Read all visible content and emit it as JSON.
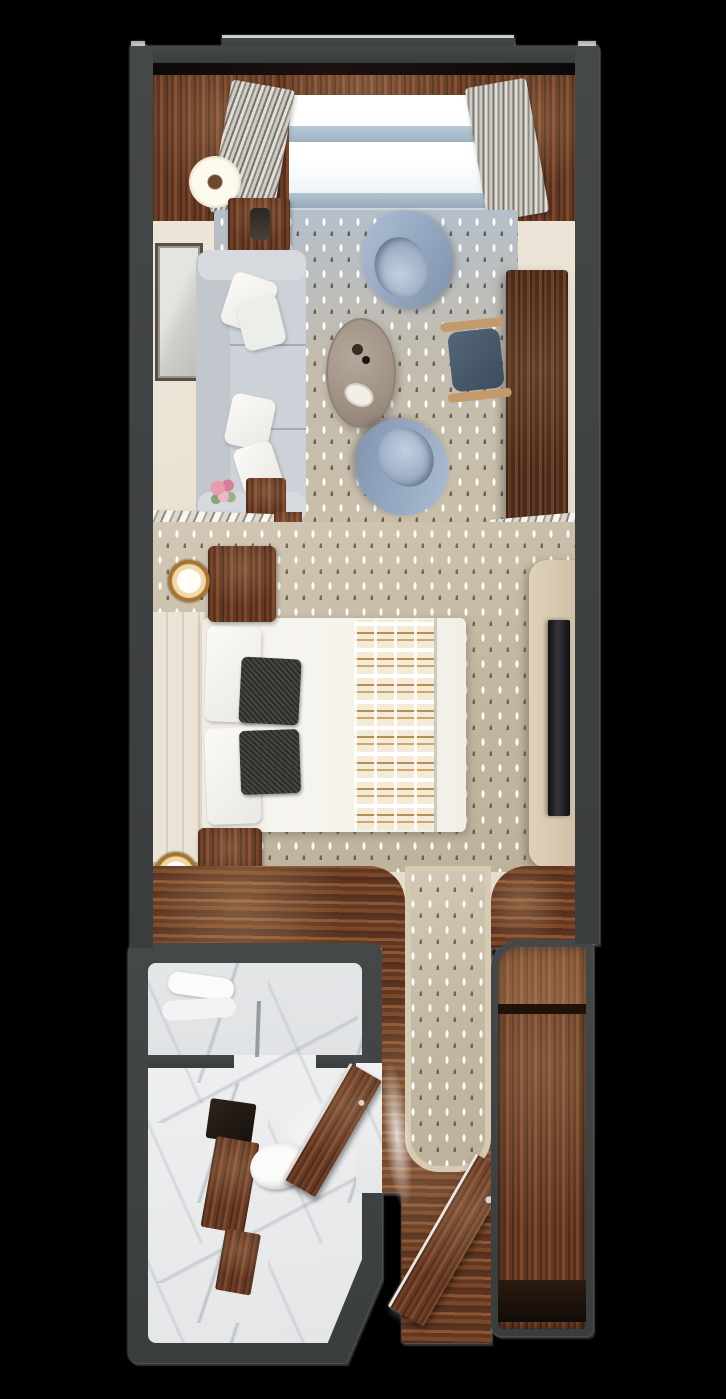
{
  "meta": {
    "title": "Stateroom suite floor plan — top-down 3D render",
    "view": "top-down architectural render",
    "visible_text": "none"
  },
  "palette": {
    "background": "#000000",
    "wall": "#3c4040",
    "wall_highlight": "#ffffff",
    "wood_mid": "#6e3f27",
    "wood_dark": "#4a2a18",
    "cream_floor": "#e9e2d4",
    "marble": "#eceeef",
    "rug_blue": "#b5bfca",
    "rug_beige": "#c9bea9",
    "carpet_beige": "#c2b7a1",
    "sofa_gray": "#cdd2d8",
    "armchair_blue": "#8ea3c0",
    "coffee_table_taupe": "#a89b8e",
    "desk_brown": "#5e3a26",
    "bed_white": "#f4f2ec",
    "accent_pillow_dark": "#2e2c29",
    "runner_tan": "#cda76b",
    "headboard_cream": "#ebe4d6",
    "tv_black": "#17171a",
    "console_beige": "#d7c8af",
    "window_glass": "#fdfdfd",
    "window_rail_blue": "#a9bac9",
    "glow_white": "#ffffff"
  },
  "zones": {
    "veranda": {
      "label": "Window wall / veranda strip"
    },
    "living": {
      "label": "Living area"
    },
    "bedroom": {
      "label": "Bedroom"
    },
    "bathroom": {
      "label": "Bathroom"
    },
    "entry": {
      "label": "Entry hallway"
    },
    "closet": {
      "label": "Wardrobe closet"
    }
  },
  "el": {
    "plan": {
      "label": "Suite floor plan, top-down view"
    },
    "interior_floor": {
      "label": "Interior floor"
    },
    "window_track": {
      "label": "Window track / threshold"
    },
    "deck_band": {
      "label": "Hardwood band at window wall"
    },
    "wood_panel_left": {
      "label": "Hardwood floor, window corner left"
    },
    "wood_panel_right": {
      "label": "Hardwood floor, window corner right"
    },
    "window_glass": {
      "label": "Floor-to-ceiling window"
    },
    "window_rail_upper": {
      "label": "Window glazing bar (upper)"
    },
    "window_rail_lower": {
      "label": "Window glazing bar (lower)"
    },
    "window_sill": {
      "label": "Window sill shadow"
    },
    "curtain_left": {
      "label": "Drapery panel, left"
    },
    "curtain_right": {
      "label": "Drapery panel, right"
    },
    "area_rug": {
      "label": "Patterned area rug"
    },
    "floor_lamp": {
      "label": "Floor lamp"
    },
    "side_table": {
      "label": "Side table"
    },
    "table_lamp": {
      "label": "Table lamp"
    },
    "wall_art": {
      "label": "Framed wall art"
    },
    "sofa": {
      "label": "Sofa"
    },
    "sofa_pillow": {
      "label": "Throw pillow"
    },
    "flower_vase": {
      "label": "Vase with flowers"
    },
    "console_table": {
      "label": "Console table"
    },
    "coffee_table": {
      "label": "Oval coffee table"
    },
    "tray": {
      "label": "Serving tray"
    },
    "decor": {
      "label": "Table decor"
    },
    "armchair_top": {
      "label": "Barrel armchair (near window)"
    },
    "armchair_bottom": {
      "label": "Barrel armchair (near bedroom)"
    },
    "desk": {
      "label": "Writing desk"
    },
    "desk_chair": {
      "label": "Desk chair"
    },
    "rack_left": {
      "label": "Slatted luggage rack, port side"
    },
    "rack_left_frame": {
      "label": "Luggage rack wood frame"
    },
    "rack_right": {
      "label": "Slatted luggage rack, starboard side"
    },
    "bedroom_carpet": {
      "label": "Bedroom carpet"
    },
    "tv_console": {
      "label": "TV console / dresser"
    },
    "tv": {
      "label": "Wall-mounted TV"
    },
    "headboard": {
      "label": "Upholstered headboard wall"
    },
    "bed": {
      "label": "Queen bed with white duvet"
    },
    "sheet_fold": {
      "label": "Duvet fold line"
    },
    "bed_pillow": {
      "label": "Bed pillow"
    },
    "accent_pillow_1": {
      "label": "Dark accent pillow"
    },
    "accent_pillow_2": {
      "label": "Dark accent pillow"
    },
    "bed_runner": {
      "label": "Patterned bed runner"
    },
    "nightstand_upper": {
      "label": "Nightstand (window side)"
    },
    "lamp_upper": {
      "label": "Bedside lamp (window side)"
    },
    "nightstand_lower": {
      "label": "Nightstand (entry side)"
    },
    "lamp_lower": {
      "label": "Bedside lamp (entry side)"
    },
    "corridor_floor_left": {
      "label": "Hardwood corridor floor, left"
    },
    "corridor_floor_right": {
      "label": "Hardwood corridor floor, right"
    },
    "hall_runner": {
      "label": "Carpet runner to entry"
    },
    "bathroom_block": {
      "label": "Bathroom"
    },
    "bathroom_floor": {
      "label": "Marble bathroom floor"
    },
    "shower": {
      "label": "Walk-in shower"
    },
    "towel": {
      "label": "Folded towels"
    },
    "shower_glass": {
      "label": "Shower glass panel"
    },
    "partition": {
      "label": "Partition wall"
    },
    "vanity_counter": {
      "label": "Vanity counter with sink"
    },
    "vanity_cabinet": {
      "label": "Vanity wood cabinet"
    },
    "toilet": {
      "label": "Toilet"
    },
    "bathroom_door": {
      "label": "Bathroom door (open)"
    },
    "door_opening": {
      "label": "Bathroom doorway"
    },
    "bath_glow": {
      "label": "Ceiling light glow"
    },
    "hallway_floor": {
      "label": "Entry hallway hardwood floor"
    },
    "entry_door": {
      "label": "Entry door (open)"
    },
    "entry_glow": {
      "label": "Doorway light"
    },
    "closet_block": {
      "label": "Wardrobe closet"
    },
    "closet_interior": {
      "label": "Closet interior, wood"
    },
    "closet_shelf": {
      "label": "Closet shelf divider"
    },
    "closet_base": {
      "label": "Closet base shadow"
    },
    "wall_top": {
      "label": "Exterior wall, top"
    },
    "wall_top_step": {
      "label": "Exterior wall step-out"
    },
    "wall_left": {
      "label": "Exterior wall, left"
    },
    "wall_right": {
      "label": "Exterior wall, right"
    },
    "wall_highlight": {
      "label": "Wall edge highlight"
    }
  }
}
